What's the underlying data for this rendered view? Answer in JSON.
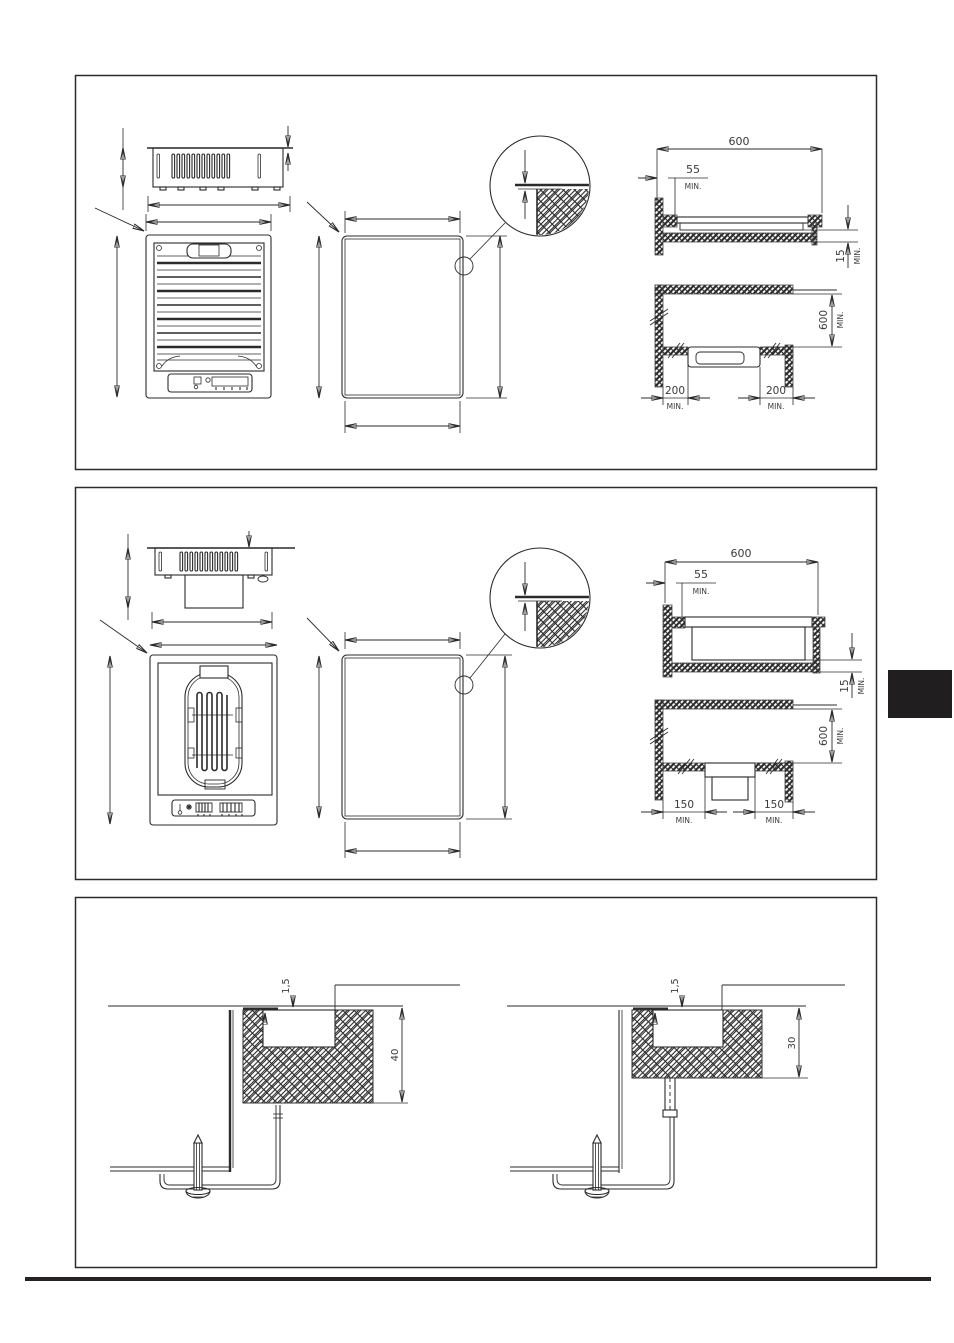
{
  "document": {
    "background": "#ffffff",
    "ink": "#2b2b2b",
    "tab_color": "#211e1f"
  },
  "panel1": {
    "top_width": {
      "value": "600"
    },
    "front_clearance": {
      "value": "55",
      "unit": "MIN."
    },
    "edge_gap": {
      "value": "15",
      "unit": "MIN."
    },
    "rear_depth": {
      "value": "600",
      "unit": "MIN."
    },
    "left_clearance": {
      "value": "200",
      "unit": "MIN."
    },
    "right_clearance": {
      "value": "200",
      "unit": "MIN."
    }
  },
  "panel2": {
    "top_width": {
      "value": "600"
    },
    "front_clearance": {
      "value": "55",
      "unit": "MIN."
    },
    "edge_gap": {
      "value": "15",
      "unit": "MIN."
    },
    "rear_depth": {
      "value": "600",
      "unit": "MIN."
    },
    "left_clearance": {
      "value": "150",
      "unit": "MIN."
    },
    "right_clearance": {
      "value": "150",
      "unit": "MIN."
    }
  },
  "panel3": {
    "left_detail": {
      "glass_thickness": "1,5",
      "recess_depth": "40"
    },
    "right_detail": {
      "glass_thickness": "1,5",
      "recess_depth": "30"
    }
  }
}
